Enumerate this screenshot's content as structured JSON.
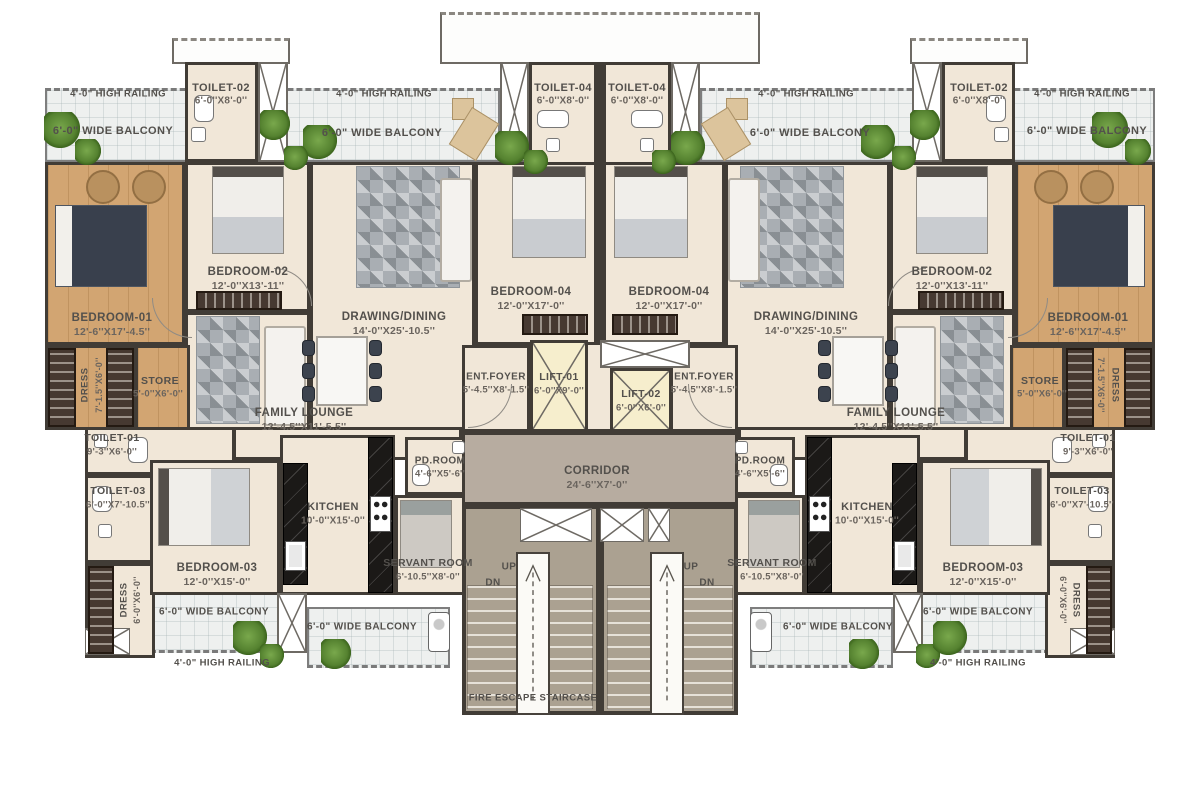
{
  "plan": {
    "type": "apartment-floor-plan",
    "labels": [
      {
        "id": "railing-top-left-1",
        "text": "4'-0\" HIGH RAILING",
        "x": 118,
        "y": 94,
        "fs": 9.5
      },
      {
        "id": "balcony-top-left-1",
        "text": "6'-0\" WIDE BALCONY",
        "x": 113,
        "y": 131,
        "fs": 11
      },
      {
        "id": "railing-top-left-2",
        "text": "4'-0\" HIGH RAILING",
        "x": 384,
        "y": 94,
        "fs": 9.5
      },
      {
        "id": "balcony-top-left-2",
        "text": "6'-0\" WIDE BALCONY",
        "x": 382,
        "y": 133,
        "fs": 11
      },
      {
        "id": "railing-top-right-2",
        "text": "4'-0\" HIGH RAILING",
        "x": 806,
        "y": 94,
        "fs": 9.5
      },
      {
        "id": "balcony-top-right-2",
        "text": "6'-0\" WIDE BALCONY",
        "x": 810,
        "y": 133,
        "fs": 11
      },
      {
        "id": "railing-top-right-1",
        "text": "4'-0\" HIGH RAILING",
        "x": 1082,
        "y": 94,
        "fs": 9.5
      },
      {
        "id": "balcony-top-right-1",
        "text": "6'-0\" WIDE BALCONY",
        "x": 1087,
        "y": 131,
        "fs": 11
      },
      {
        "id": "toilet-02-left-name",
        "text": "TOILET-02",
        "x": 221,
        "y": 88,
        "fs": 11
      },
      {
        "id": "toilet-02-left-dims",
        "text": "6'-0''X8'-0''",
        "x": 221,
        "y": 101,
        "fs": 10,
        "cls": "dim"
      },
      {
        "id": "toilet-04-left-name",
        "text": "TOILET-04",
        "x": 563,
        "y": 88,
        "fs": 11
      },
      {
        "id": "toilet-04-left-dims",
        "text": "6'-0''X8'-0''",
        "x": 563,
        "y": 101,
        "fs": 10,
        "cls": "dim"
      },
      {
        "id": "toilet-04-right-name",
        "text": "TOILET-04",
        "x": 637,
        "y": 88,
        "fs": 11
      },
      {
        "id": "toilet-04-right-dims",
        "text": "6'-0''X8'-0''",
        "x": 637,
        "y": 101,
        "fs": 10,
        "cls": "dim"
      },
      {
        "id": "toilet-02-right-name",
        "text": "TOILET-02",
        "x": 979,
        "y": 88,
        "fs": 11
      },
      {
        "id": "toilet-02-right-dims",
        "text": "6'-0''X8'-0''",
        "x": 979,
        "y": 101,
        "fs": 10,
        "cls": "dim"
      },
      {
        "id": "bedroom-01-left-name",
        "text": "BEDROOM-01",
        "x": 112,
        "y": 318,
        "fs": 11.5
      },
      {
        "id": "bedroom-01-left-dims",
        "text": "12'-6''X17'-4.5''",
        "x": 112,
        "y": 332,
        "fs": 10.5,
        "cls": "dim"
      },
      {
        "id": "bedroom-02-left-name",
        "text": "BEDROOM-02",
        "x": 248,
        "y": 272,
        "fs": 11.5
      },
      {
        "id": "bedroom-02-left-dims",
        "text": "12'-0''X13'-11''",
        "x": 248,
        "y": 286,
        "fs": 10.5,
        "cls": "dim"
      },
      {
        "id": "drawing-dining-left-name",
        "text": "DRAWING/DINING",
        "x": 394,
        "y": 317,
        "fs": 11.5
      },
      {
        "id": "drawing-dining-left-dims",
        "text": "14'-0''X25'-10.5''",
        "x": 394,
        "y": 331,
        "fs": 10.5,
        "cls": "dim"
      },
      {
        "id": "bedroom-04-left-name",
        "text": "BEDROOM-04",
        "x": 531,
        "y": 292,
        "fs": 11.5
      },
      {
        "id": "bedroom-04-left-dims",
        "text": "12'-0''X17'-0''",
        "x": 531,
        "y": 306,
        "fs": 10.5,
        "cls": "dim"
      },
      {
        "id": "bedroom-04-right-name",
        "text": "BEDROOM-04",
        "x": 669,
        "y": 292,
        "fs": 11.5
      },
      {
        "id": "bedroom-04-right-dims",
        "text": "12'-0''X17'-0''",
        "x": 669,
        "y": 306,
        "fs": 10.5,
        "cls": "dim"
      },
      {
        "id": "drawing-dining-right-name",
        "text": "DRAWING/DINING",
        "x": 806,
        "y": 317,
        "fs": 11.5
      },
      {
        "id": "drawing-dining-right-dims",
        "text": "14'-0''X25'-10.5''",
        "x": 806,
        "y": 331,
        "fs": 10.5,
        "cls": "dim"
      },
      {
        "id": "bedroom-02-right-name",
        "text": "BEDROOM-02",
        "x": 952,
        "y": 272,
        "fs": 11.5
      },
      {
        "id": "bedroom-02-right-dims",
        "text": "12'-0''X13'-11''",
        "x": 952,
        "y": 286,
        "fs": 10.5,
        "cls": "dim"
      },
      {
        "id": "bedroom-01-right-name",
        "text": "BEDROOM-01",
        "x": 1088,
        "y": 318,
        "fs": 11.5
      },
      {
        "id": "bedroom-01-right-dims",
        "text": "12'-6''X17'-4.5''",
        "x": 1088,
        "y": 332,
        "fs": 10.5,
        "cls": "dim"
      },
      {
        "id": "dress-1-left-name",
        "text": "DRESS",
        "x": 85,
        "y": 385,
        "fs": 9.5,
        "rot": -90
      },
      {
        "id": "dress-1-left-dims",
        "text": "7'-1.5''X6'-0''",
        "x": 99,
        "y": 385,
        "fs": 9,
        "rot": -90,
        "cls": "dim"
      },
      {
        "id": "store-left-name",
        "text": "STORE",
        "x": 160,
        "y": 381,
        "fs": 10.5
      },
      {
        "id": "store-left-dims",
        "text": "5'-0''X6'-0''",
        "x": 158,
        "y": 394,
        "fs": 9.5,
        "cls": "dim"
      },
      {
        "id": "family-lounge-left-name",
        "text": "FAMILY LOUNGE",
        "x": 304,
        "y": 413,
        "fs": 11.5
      },
      {
        "id": "family-lounge-left-dims",
        "text": "12'-4.5''X11'-5.5''",
        "x": 304,
        "y": 427,
        "fs": 10.5,
        "cls": "dim"
      },
      {
        "id": "ent-foyer-left-name",
        "text": "ENT.FOYER",
        "x": 496,
        "y": 377,
        "fs": 10
      },
      {
        "id": "ent-foyer-left-dims",
        "text": "5'-4.5''X8'-1.5''",
        "x": 496,
        "y": 390,
        "fs": 9.5,
        "cls": "dim"
      },
      {
        "id": "lift-01-name",
        "text": "LIFT-01",
        "x": 559,
        "y": 377,
        "fs": 10.5
      },
      {
        "id": "lift-01-dims",
        "text": "6'-0''X9'-0''",
        "x": 559,
        "y": 391,
        "fs": 9.5,
        "cls": "dim"
      },
      {
        "id": "lift-02-name",
        "text": "LIFT-02",
        "x": 641,
        "y": 394,
        "fs": 10.5
      },
      {
        "id": "lift-02-dims",
        "text": "6'-0''X6'-0''",
        "x": 641,
        "y": 408,
        "fs": 9.5,
        "cls": "dim"
      },
      {
        "id": "ent-foyer-right-name",
        "text": "ENT.FOYER",
        "x": 704,
        "y": 377,
        "fs": 10
      },
      {
        "id": "ent-foyer-right-dims",
        "text": "5'-4.5''X8'-1.5''",
        "x": 704,
        "y": 390,
        "fs": 9.5,
        "cls": "dim"
      },
      {
        "id": "family-lounge-right-name",
        "text": "FAMILY LOUNGE",
        "x": 896,
        "y": 413,
        "fs": 11.5
      },
      {
        "id": "family-lounge-right-dims",
        "text": "12'-4.5''X11'-5.5''",
        "x": 896,
        "y": 427,
        "fs": 10.5,
        "cls": "dim"
      },
      {
        "id": "store-right-name",
        "text": "STORE",
        "x": 1040,
        "y": 381,
        "fs": 10.5
      },
      {
        "id": "store-right-dims",
        "text": "5'-0''X6'-0''",
        "x": 1042,
        "y": 394,
        "fs": 9.5,
        "cls": "dim"
      },
      {
        "id": "dress-1-right-name",
        "text": "DRESS",
        "x": 1115,
        "y": 385,
        "fs": 9.5,
        "rot": 90
      },
      {
        "id": "dress-1-right-dims",
        "text": "7'-1.5''X6'-0''",
        "x": 1101,
        "y": 385,
        "fs": 9,
        "rot": 90,
        "cls": "dim"
      },
      {
        "id": "toilet-01-left-name",
        "text": "TOILET-01",
        "x": 112,
        "y": 438,
        "fs": 10.5
      },
      {
        "id": "toilet-01-left-dims",
        "text": "9'-3''X6'-0''",
        "x": 112,
        "y": 452,
        "fs": 9.5,
        "cls": "dim"
      },
      {
        "id": "toilet-01-right-name",
        "text": "TOILET-01",
        "x": 1088,
        "y": 438,
        "fs": 10.5
      },
      {
        "id": "toilet-01-right-dims",
        "text": "9'-3''X6'-0''",
        "x": 1088,
        "y": 452,
        "fs": 9.5,
        "cls": "dim"
      },
      {
        "id": "toilet-03-left-name",
        "text": "TOILET-03",
        "x": 118,
        "y": 491,
        "fs": 10.5
      },
      {
        "id": "toilet-03-left-dims",
        "text": "6'-0''X7'-10.5''",
        "x": 118,
        "y": 505,
        "fs": 9.5,
        "cls": "dim"
      },
      {
        "id": "toilet-03-right-name",
        "text": "TOILET-03",
        "x": 1082,
        "y": 491,
        "fs": 10.5
      },
      {
        "id": "toilet-03-right-dims",
        "text": "6'-0''X7'-10.5''",
        "x": 1082,
        "y": 505,
        "fs": 9.5,
        "cls": "dim"
      },
      {
        "id": "corridor-name",
        "text": "CORRIDOR",
        "x": 597,
        "y": 471,
        "fs": 11.5
      },
      {
        "id": "corridor-dims",
        "text": "24'-6''X7'-0''",
        "x": 597,
        "y": 485,
        "fs": 10.5,
        "cls": "dim"
      },
      {
        "id": "pd-room-left-name",
        "text": "PD.ROOM",
        "x": 440,
        "y": 461,
        "fs": 10
      },
      {
        "id": "pd-room-left-dims",
        "text": "4'-6''X5'-6''",
        "x": 440,
        "y": 474,
        "fs": 9.5,
        "cls": "dim"
      },
      {
        "id": "pd-room-right-name",
        "text": "PD.ROOM",
        "x": 760,
        "y": 461,
        "fs": 10
      },
      {
        "id": "pd-room-right-dims",
        "text": "4'-6''X5'-6''",
        "x": 760,
        "y": 474,
        "fs": 9.5,
        "cls": "dim"
      },
      {
        "id": "kitchen-left-name",
        "text": "KITCHEN",
        "x": 333,
        "y": 507,
        "fs": 11
      },
      {
        "id": "kitchen-left-dims",
        "text": "10'-0''X15'-0''",
        "x": 333,
        "y": 521,
        "fs": 10,
        "cls": "dim"
      },
      {
        "id": "kitchen-right-name",
        "text": "KITCHEN",
        "x": 867,
        "y": 507,
        "fs": 11
      },
      {
        "id": "kitchen-right-dims",
        "text": "10'-0''X15'-0''",
        "x": 867,
        "y": 521,
        "fs": 10,
        "cls": "dim"
      },
      {
        "id": "servant-room-left-name",
        "text": "SERVANT ROOM",
        "x": 428,
        "y": 563,
        "fs": 10.5
      },
      {
        "id": "servant-room-left-dims",
        "text": "6'-10.5''X8'-0''",
        "x": 428,
        "y": 577,
        "fs": 9.5,
        "cls": "dim"
      },
      {
        "id": "servant-room-right-name",
        "text": "SERVANT ROOM",
        "x": 772,
        "y": 563,
        "fs": 10.5
      },
      {
        "id": "servant-room-right-dims",
        "text": "6'-10.5''X8'-0''",
        "x": 772,
        "y": 577,
        "fs": 9.5,
        "cls": "dim"
      },
      {
        "id": "bedroom-03-left-name",
        "text": "BEDROOM-03",
        "x": 217,
        "y": 568,
        "fs": 11.5
      },
      {
        "id": "bedroom-03-left-dims",
        "text": "12'-0''X15'-0''",
        "x": 217,
        "y": 582,
        "fs": 10.5,
        "cls": "dim"
      },
      {
        "id": "bedroom-03-right-name",
        "text": "BEDROOM-03",
        "x": 983,
        "y": 568,
        "fs": 11.5
      },
      {
        "id": "bedroom-03-right-dims",
        "text": "12'-0''X15'-0''",
        "x": 983,
        "y": 582,
        "fs": 10.5,
        "cls": "dim"
      },
      {
        "id": "dress-2-left-name",
        "text": "DRESS",
        "x": 124,
        "y": 600,
        "fs": 9.5,
        "rot": -90
      },
      {
        "id": "dress-2-left-dims",
        "text": "6'-0''X6'-0''",
        "x": 137,
        "y": 600,
        "fs": 9,
        "rot": -90,
        "cls": "dim"
      },
      {
        "id": "dress-2-right-name",
        "text": "DRESS",
        "x": 1076,
        "y": 600,
        "fs": 9.5,
        "rot": 90
      },
      {
        "id": "dress-2-right-dims",
        "text": "6'-0''X6'-0''",
        "x": 1063,
        "y": 600,
        "fs": 9,
        "rot": 90,
        "cls": "dim"
      },
      {
        "id": "stair-up-left",
        "text": "UP",
        "x": 509,
        "y": 567,
        "fs": 10
      },
      {
        "id": "stair-dn-left",
        "text": "DN",
        "x": 493,
        "y": 583,
        "fs": 10
      },
      {
        "id": "stair-up-right",
        "text": "UP",
        "x": 691,
        "y": 567,
        "fs": 10
      },
      {
        "id": "stair-dn-right",
        "text": "DN",
        "x": 707,
        "y": 583,
        "fs": 10
      },
      {
        "id": "balcony-bottom-left-a",
        "text": "6'-0\" WIDE BALCONY",
        "x": 214,
        "y": 612,
        "fs": 10
      },
      {
        "id": "balcony-bottom-left-b",
        "text": "6'-0\" WIDE BALCONY",
        "x": 362,
        "y": 627,
        "fs": 10
      },
      {
        "id": "balcony-bottom-right-b",
        "text": "6'-0\" WIDE BALCONY",
        "x": 838,
        "y": 627,
        "fs": 10
      },
      {
        "id": "balcony-bottom-right-a",
        "text": "6'-0\" WIDE BALCONY",
        "x": 978,
        "y": 612,
        "fs": 10
      },
      {
        "id": "railing-bottom-left",
        "text": "4'-0\" HIGH RAILING",
        "x": 222,
        "y": 663,
        "fs": 9.5
      },
      {
        "id": "railing-bottom-right",
        "text": "4'-0\" HIGH RAILING",
        "x": 978,
        "y": 663,
        "fs": 9.5
      },
      {
        "id": "fire-escape-staircase",
        "text": "FIRE ESCAPE STAIRCASE",
        "x": 533,
        "y": 698,
        "fs": 9.5
      }
    ]
  },
  "colors": {
    "wall": "#413c36",
    "cream": "#f1e7d8",
    "wood": "#d2a572",
    "tile": "#eef0ef",
    "corridor": "#b7aca0",
    "stairs": "#aba191",
    "lift": "#f6eecd",
    "label": "#53504c",
    "counter": "#1b1917",
    "rug": "#a9aeb3",
    "wardrobe": "#463931",
    "plant": "#558230"
  }
}
